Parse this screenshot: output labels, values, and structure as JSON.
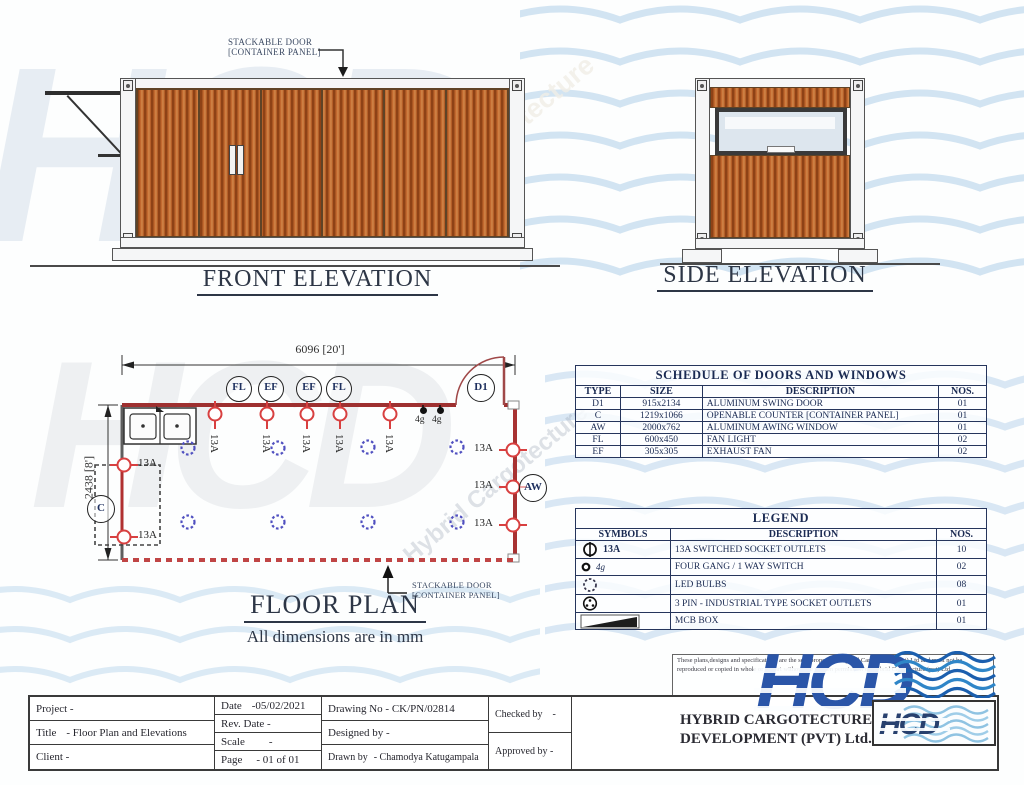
{
  "watermark": {
    "letters": "HCD",
    "diagonal_text": "Hybrid Cargotecture"
  },
  "front_elevation": {
    "title": "FRONT ELEVATION",
    "door_label": {
      "line1": "STACKABLE DOOR",
      "line2": "[CONTAINER PANEL]"
    }
  },
  "side_elevation": {
    "title": "SIDE ELEVATION"
  },
  "floor_plan": {
    "title": "FLOOR PLAN",
    "subtitle": "All dimensions are in mm",
    "width_dim": "6096 [20']",
    "height_dim": "2438 [8']",
    "door_label": {
      "line1": "STACKABLE DOOR",
      "line2": "[CONTAINER PANEL]"
    },
    "ceiling_tags": [
      "FL",
      "EF",
      "EF",
      "FL"
    ],
    "door_tag": "D1",
    "counter_tag": "C",
    "window_tag": "AW",
    "socket_label": "13A",
    "switch_label": "4g"
  },
  "schedule_table": {
    "title": "SCHEDULE OF DOORS AND WINDOWS",
    "headers": [
      "TYPE",
      "SIZE",
      "DESCRIPTION",
      "NOS."
    ],
    "rows": [
      [
        "D1",
        "915x2134",
        "ALUMINUM SWING DOOR",
        "01"
      ],
      [
        "C",
        "1219x1066",
        "OPENABLE COUNTER [CONTAINER PANEL]",
        "01"
      ],
      [
        "AW",
        "2000x762",
        "ALUMINUM AWING WINDOW",
        "01"
      ],
      [
        "FL",
        "600x450",
        "FAN LIGHT",
        "02"
      ],
      [
        "EF",
        "305x305",
        "EXHAUST FAN",
        "02"
      ]
    ]
  },
  "legend_table": {
    "title": "LEGEND",
    "headers": [
      "SYMBOLS",
      "DESCRIPTION",
      "NOS."
    ],
    "rows": [
      {
        "symbol": "socket-outlet",
        "symbol_label": "13A",
        "description": "13A SWITCHED SOCKET OUTLETS",
        "nos": "10"
      },
      {
        "symbol": "switch",
        "symbol_label": "4g",
        "description": "FOUR GANG / 1 WAY SWITCH",
        "nos": "02"
      },
      {
        "symbol": "led-bulb",
        "symbol_label": "",
        "description": "LED BULBS",
        "nos": "08"
      },
      {
        "symbol": "industrial-socket",
        "symbol_label": "",
        "description": "3 PIN - INDUSTRIAL TYPE SOCKET OUTLETS",
        "nos": "01"
      },
      {
        "symbol": "mcb-box",
        "symbol_label": "",
        "description": "MCB BOX",
        "nos": "01"
      }
    ]
  },
  "title_block": {
    "project_label": "Project -",
    "title_label": "Title",
    "title_value": "- Floor Plan and Elevations",
    "client_label": "Client -",
    "date_label": "Date",
    "date_value": "-05/02/2021",
    "rev_date_label": "Rev. Date -",
    "scale_label": "Scale",
    "scale_value": "-",
    "page_label": "Page",
    "page_value": "- 01 of 01",
    "drawing_no": "Drawing No - CK/PN/02814",
    "designed_by": "Designed by -",
    "drawn_by_label": "Drawn by",
    "drawn_by_value": "- Chamodya Katugampala",
    "checked_by_label": "Checked by",
    "checked_by_value": "-",
    "approved_by": "Approved by -",
    "company_name_line1": "HYBRID CARGOTECTURE",
    "company_name_line2": "DEVELOPMENT (PVT) Ltd.",
    "disclaimer": "These plans,designs and specifications are the sole property of Hybrid Cargotecture (pvt) Ltd and must not be reproduced or copied in whole or in part without the written permission of Hybrid Cargotecture (pvt) Ltd.",
    "logo_text": "HCD"
  }
}
